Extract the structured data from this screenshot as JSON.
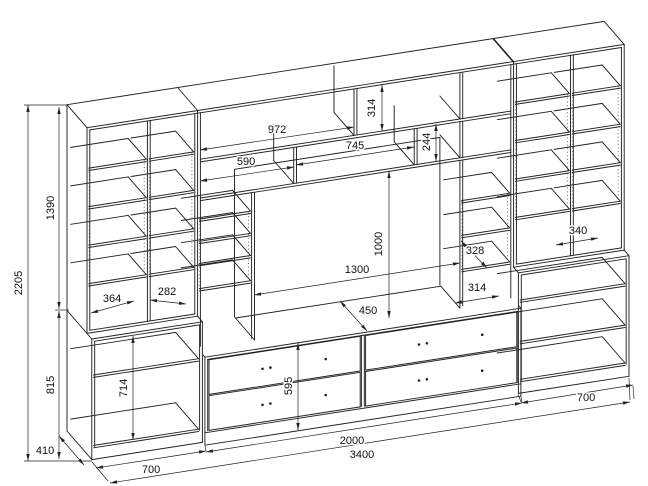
{
  "drawing": {
    "kind": "furniture wall unit technical drawing",
    "colors": {
      "line": "#222222",
      "background": "#ffffff"
    }
  },
  "dimensions": {
    "overall_height": "2205",
    "upper_section_height": "1390",
    "lower_section_height": "815",
    "lower_inner_height": "714",
    "side_depth": "410",
    "left_section_width": "700",
    "left_shelf_width": "364",
    "left_shelf_width_2": "282",
    "top_shelf_width": "972",
    "upper_shelf_width": "745",
    "upper_shelf_width_2": "590",
    "top_compartment_height": "314",
    "second_compartment_height": "244",
    "tv_niche_width": "1300",
    "tv_niche_height": "1000",
    "tv_shelf_depth": "450",
    "right_inner_width": "328",
    "right_inner_width_2": "314",
    "right_shelf_width": "340",
    "tv_stand_height": "595",
    "center_section_width": "2000",
    "total_width": "3400",
    "right_section_width": "700"
  }
}
